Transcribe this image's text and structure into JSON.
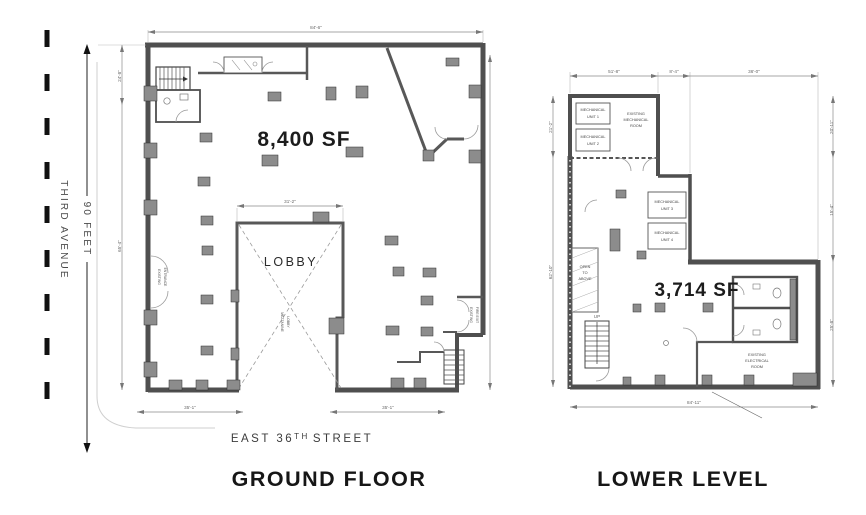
{
  "context": {
    "avenue_label": "THIRD AVENUE",
    "avenue_dim": "90 FEET",
    "street_prefix": "EAST 36",
    "street_sup": "TH",
    "street_suffix": "STREET"
  },
  "plans": {
    "ground": {
      "title": "GROUND FLOOR",
      "area": "8,400 SF",
      "lobby": "LOBBY",
      "lobby_note": [
        "MEZZANINE",
        "LOBBY"
      ],
      "entrance_note": [
        "EXISTING",
        "ENTRANCE"
      ],
      "exit_note": [
        "EXISTING",
        "FIRE EXIT"
      ],
      "dims": {
        "top": "84'-6\"",
        "left_upper": "24'-8\"",
        "left_lower": "65'-4\"",
        "lobby": "31'-2\"",
        "bottom_left": "35'-1\"",
        "bottom_right": "35'-1\""
      }
    },
    "lower": {
      "title": "LOWER LEVEL",
      "area": "3,714 SF",
      "mech_room": [
        "EXISTING",
        "MECHANICAL",
        "ROOM"
      ],
      "unit1": [
        "MECHANICAL",
        "UNIT 1"
      ],
      "unit2": [
        "MECHANICAL",
        "UNIT 2"
      ],
      "unit3": [
        "MECHANICAL",
        "UNIT 3"
      ],
      "unit4": [
        "MECHANICAL",
        "UNIT 4"
      ],
      "open_above": [
        "OPEN",
        "TO",
        "ABOVE"
      ],
      "up": "UP",
      "electrical": [
        "EXISTING",
        "ELECTRICAL",
        "ROOM"
      ],
      "dims": {
        "top_left": "51'-8\"",
        "top_mid": "8'-4\"",
        "top_right": "36'-0\"",
        "right_upper": "20'-11\"",
        "right_mid": "15'-4\"",
        "right_lower": "25'-8\"",
        "left_upper": "21'-2\"",
        "left_lower": "62'-10\"",
        "bottom": "84'-11\""
      }
    }
  },
  "colors": {
    "wall": "#4f4f4f",
    "column": "#8c8c8c",
    "dashed_line": "#111111"
  }
}
